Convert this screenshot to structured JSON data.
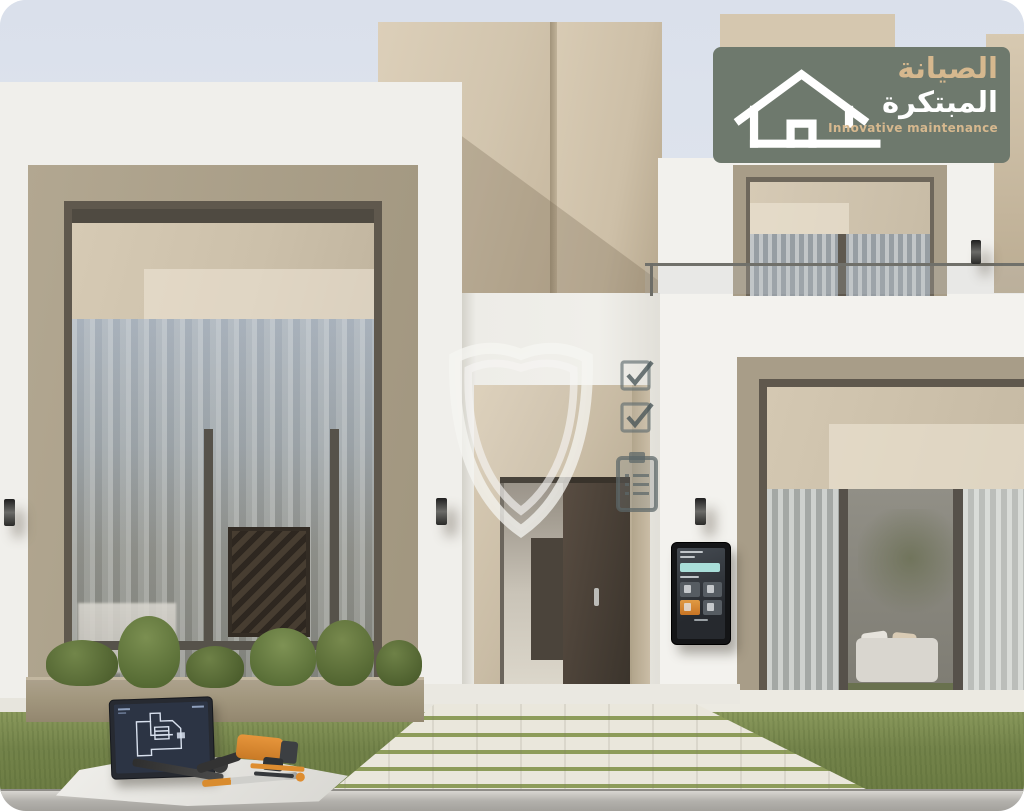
{
  "brand": {
    "logo": {
      "arabic_line1": "الصيانة",
      "arabic_line2": "المبتكرة",
      "tagline": "Innovative maintenance",
      "background_color": "#6E796D",
      "primary_text_color": "#D6B88E",
      "secondary_text_color": "#FFFFFF",
      "icon": "house-outline-icon"
    }
  },
  "watermarks": {
    "icons": [
      "shield-icon",
      "checkbox-checked-icon",
      "checkbox-checked-icon",
      "clipboard-checklist-icon"
    ]
  },
  "scene": {
    "subject": "modern two-storey villa exterior render",
    "elements": [
      "left panoramic window",
      "open entrance door",
      "smart wall control panel",
      "balcony window with glass railing",
      "right living-room window with sofa view",
      "planter with shrubs",
      "lawn with paved walkway",
      "tablet showing floor plan",
      "hand tools on drop cloth"
    ]
  },
  "palette": {
    "sky": "#DDE3ED",
    "facade_white": "#F0EFEB",
    "facade_beige": "#D3C5AD",
    "window_frame": "#A89D88",
    "roller_shade": "#D0C4AE",
    "door_brown": "#4A4238",
    "grass": "#7A8A4D",
    "paver": "#E9E6DB",
    "curb": "#AFADA8",
    "panel_accent_teal": "#A9DED9",
    "panel_accent_orange": "#D9822D",
    "tool_orange": "#D9822D",
    "blueprint_screen": "#2C3444"
  }
}
